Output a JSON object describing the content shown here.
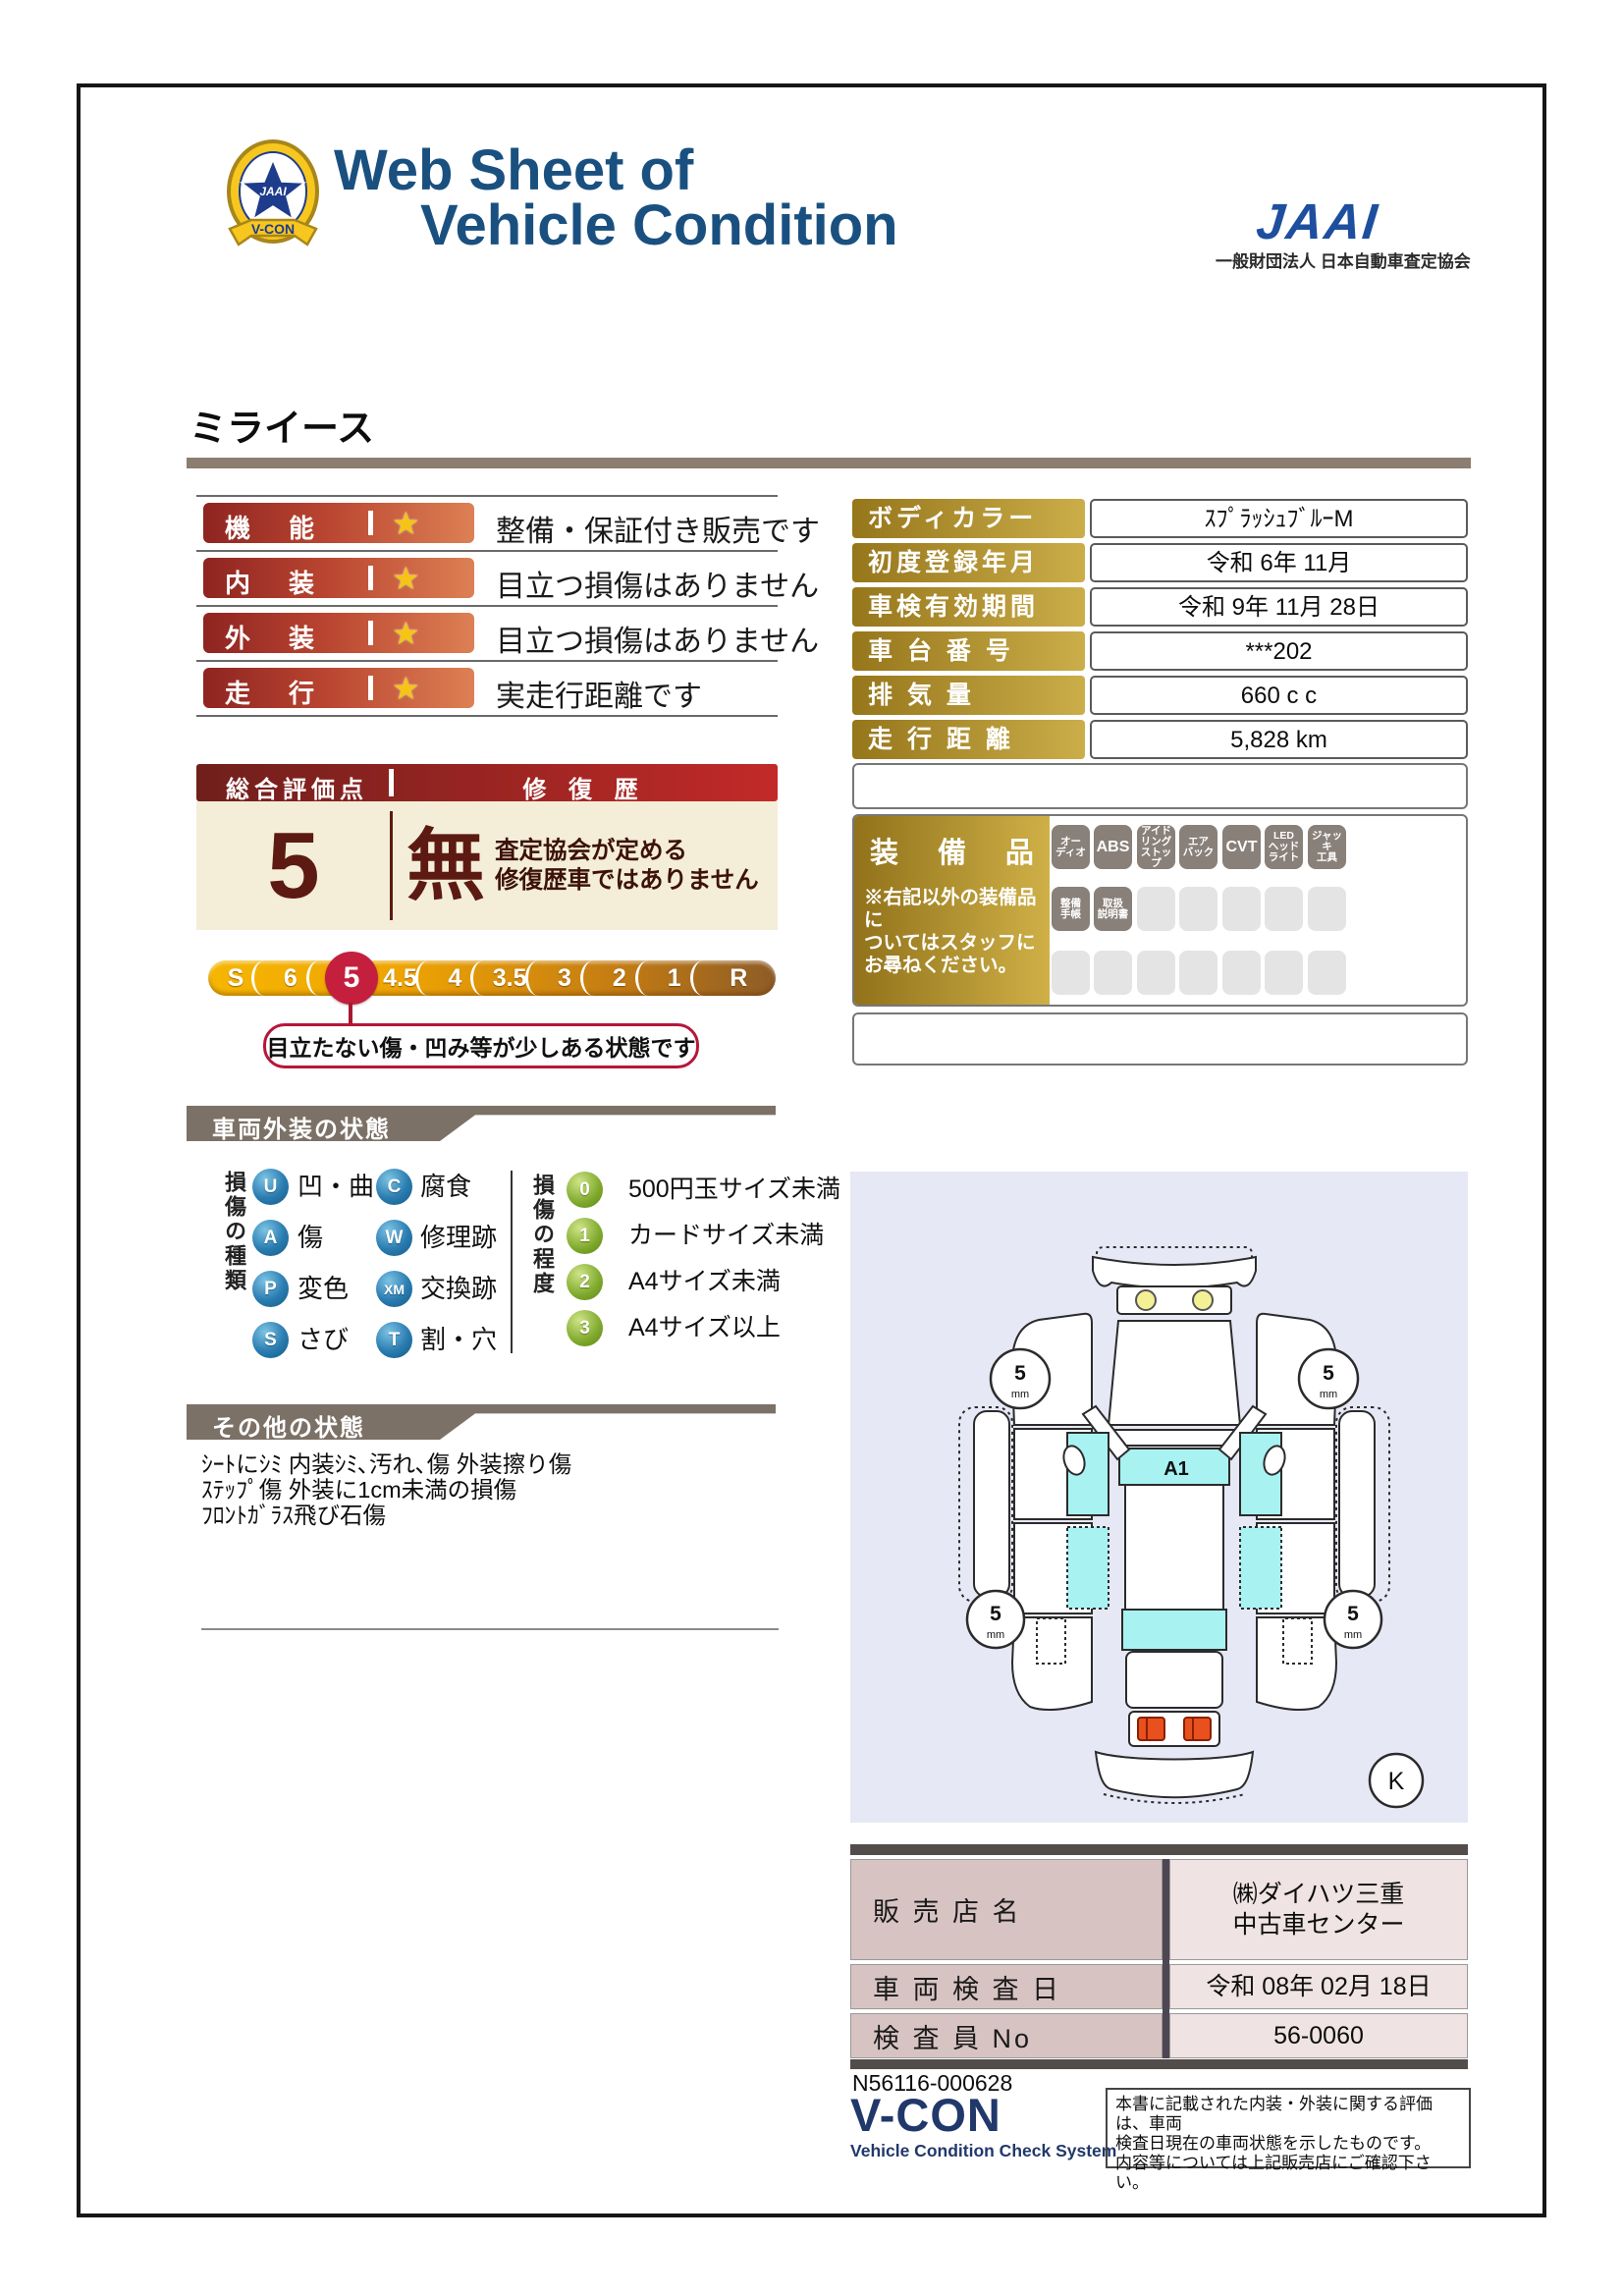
{
  "header": {
    "title_line1": "Web Sheet of",
    "title_line2": "Vehicle Condition",
    "jaai_logo": "JAAI",
    "jaai_subtitle": "一般財団法人 日本自動車査定協会",
    "emblem": {
      "center": "JAAI",
      "ribbon": "V-CON",
      "ring_text": "VEHICLE CONDITION CHECK SYSTEM",
      "star": "★"
    }
  },
  "vehicle_name": "ミライース",
  "ratings": [
    {
      "label": "機　能",
      "star": "★",
      "comment": "整備・保証付き販売です"
    },
    {
      "label": "内　装",
      "star": "★",
      "comment": "目立つ損傷はありません"
    },
    {
      "label": "外　装",
      "star": "★",
      "comment": "目立つ損傷はありません"
    },
    {
      "label": "走　行",
      "star": "★",
      "comment": "実走行距離です"
    }
  ],
  "spec_table": {
    "rows": [
      {
        "label": "ボディカラー",
        "value": "ｽﾌﾟﾗｯｼｭﾌﾞﾙｰM"
      },
      {
        "label": "初度登録年月",
        "value": "令和 6年 11月"
      },
      {
        "label": "車検有効期間",
        "value": "令和 9年 11月 28日"
      },
      {
        "label": "車 台 番 号",
        "value": "***202"
      },
      {
        "label": "排 気 量",
        "value": "660 c c"
      },
      {
        "label": "走 行 距 離",
        "value": "5,828 km"
      }
    ]
  },
  "overall": {
    "header_left": "総合評価点",
    "header_right": "修 復 歴",
    "score": "5",
    "repair_status": "無",
    "repair_note": "査定協会が定める\n修復歴車ではありません"
  },
  "scale": {
    "segments": [
      "S",
      "6",
      "5",
      "4.5",
      "4",
      "3.5",
      "3",
      "2",
      "1",
      "R"
    ],
    "selected": "5",
    "tooltip": "目立たない傷・凹み等が少しある状態です"
  },
  "equipment": {
    "title": "装 備 品",
    "note": "※右記以外の装備品に\nついてはスタッフに\nお尋ねください。",
    "row1": [
      "オー\nディオ",
      "ABS",
      "アイド\nリング\nストップ",
      "エア\nバック",
      "CVT",
      "LED\nヘッド\nライト",
      "ジャッキ\n工具"
    ],
    "row2": [
      "整備\n手帳",
      "取扱\n説明書"
    ]
  },
  "exterior": {
    "header": "車両外装の状態",
    "type_title": "損傷の種類",
    "types_col1": [
      {
        "code": "U",
        "label": "凹・曲"
      },
      {
        "code": "A",
        "label": "傷"
      },
      {
        "code": "P",
        "label": "変色"
      },
      {
        "code": "S",
        "label": "さび"
      }
    ],
    "types_col2": [
      {
        "code": "C",
        "label": "腐食"
      },
      {
        "code": "W",
        "label": "修理跡"
      },
      {
        "code": "XM",
        "label": "交換跡"
      },
      {
        "code": "T",
        "label": "割・穴"
      }
    ],
    "degree_title": "損傷の程度",
    "degrees": [
      {
        "code": "0",
        "label": "500円玉サイズ未満"
      },
      {
        "code": "1",
        "label": "カードサイズ未満"
      },
      {
        "code": "2",
        "label": "A4サイズ未満"
      },
      {
        "code": "3",
        "label": "A4サイズ以上"
      }
    ]
  },
  "other_condition": {
    "header": "その他の状態",
    "text": "ｼｰﾄにｼﾐ 内装ｼﾐ､汚れ､傷 外装擦り傷\nｽﾃｯﾌﾟ傷 外装に1cm未満の損傷\nﾌﾛﾝﾄｶﾞﾗｽ飛び石傷"
  },
  "diagram": {
    "windshield_mark": "A1",
    "tire_depth": "5",
    "tire_unit": "mm",
    "corner_mark": "K"
  },
  "dealer_table": {
    "rows": [
      {
        "label": "販 売 店 名",
        "value": "㈱ダイハツ三重\n中古車センター"
      },
      {
        "label": "車 両 検 査 日",
        "value": "令和 08年 02月 18日"
      },
      {
        "label": "検 査 員 No",
        "value": "56-0060"
      }
    ]
  },
  "footer": {
    "doc_number": "N56116-000628",
    "vcon": "V-CON",
    "vcon_sub": "Vehicle Condition Check System",
    "disclaimer": "本書に記載された内装・外装に関する評価は、車両\n検査日現在の車両状態を示したものです。\n内容等については上記販売店にご確認下さい。"
  }
}
